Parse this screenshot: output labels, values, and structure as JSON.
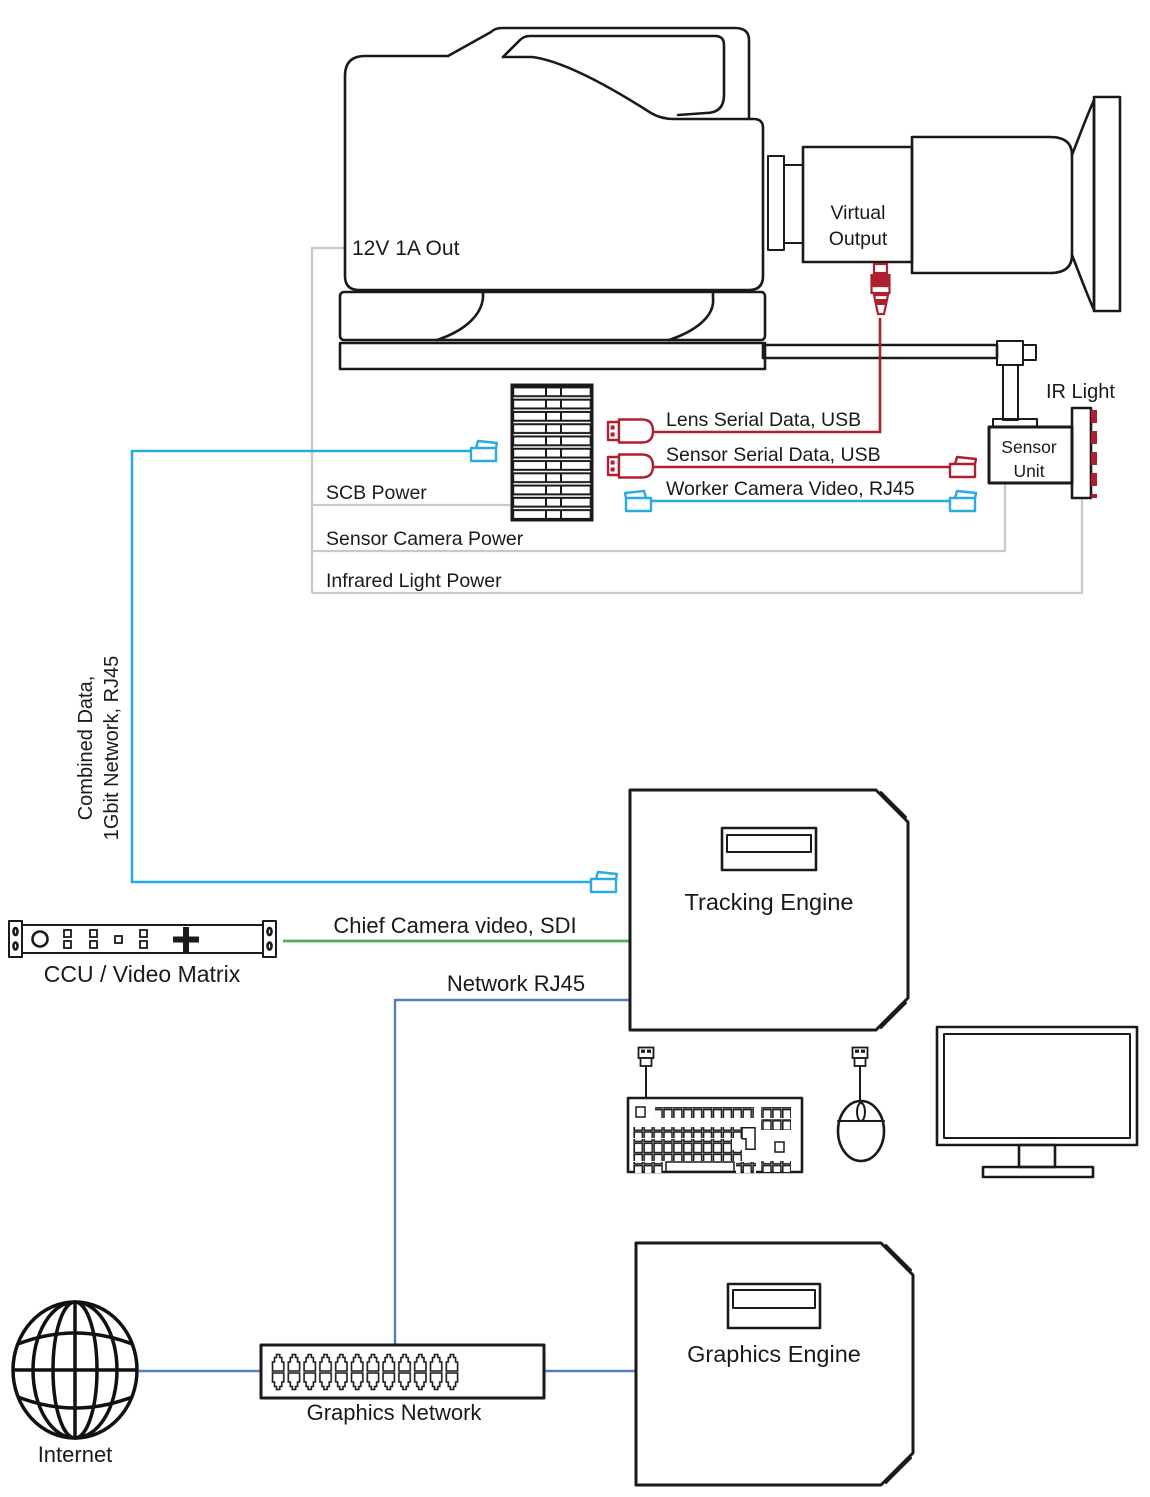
{
  "diagram": {
    "camera": {
      "power_label": "12V 1A Out"
    },
    "viewfinder": {
      "label_line1": "Virtual",
      "label_line2": "Output"
    },
    "sensor_unit": {
      "label_line1": "Sensor",
      "label_line2": "Unit"
    },
    "ir_light": {
      "label": "IR Light"
    },
    "cables": {
      "lens_serial": "Lens Serial Data, USB",
      "sensor_serial": "Sensor Serial Data, USB",
      "worker_video": "Worker Camera Video, RJ45",
      "scb_power": "SCB Power",
      "sensor_camera_power": "Sensor Camera Power",
      "infrared_power": "Infrared Light Power",
      "combined_line1": "Combined Data,",
      "combined_line2": "1Gbit Network, RJ45",
      "chief_video": "Chief Camera video, SDI",
      "network": "Network RJ45"
    },
    "devices": {
      "ccu": "CCU / Video Matrix",
      "tracking_engine": "Tracking Engine",
      "graphics_engine": "Graphics Engine",
      "graphics_network": "Graphics Network",
      "internet": "Internet"
    },
    "colors": {
      "cyan_rj45": "#29abe2",
      "red_usb": "#b01f30",
      "green_sdi": "#4cae61",
      "blue_network": "#567fb9",
      "gray_power": "#c9c9c9",
      "ink": "#1a1a1a"
    }
  }
}
